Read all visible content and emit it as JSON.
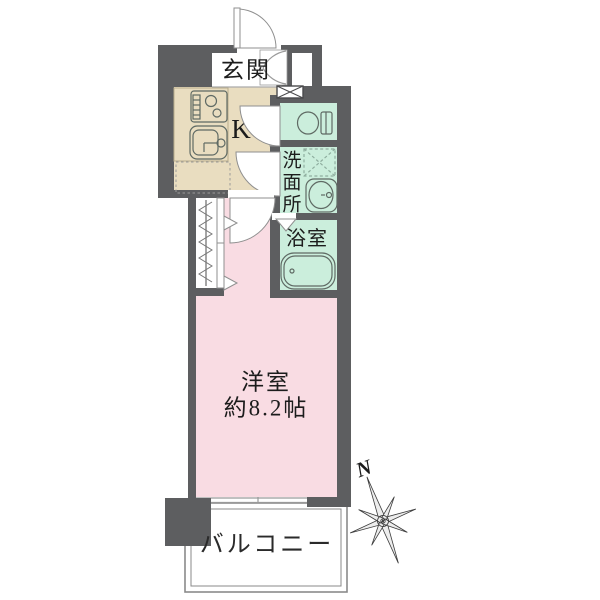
{
  "rooms": {
    "entrance": {
      "label": "玄関"
    },
    "kitchen": {
      "label": "K"
    },
    "washroom": {
      "label": "洗面所",
      "chars": [
        "洗",
        "面",
        "所"
      ]
    },
    "bathroom": {
      "label": "浴室"
    },
    "main_room": {
      "label": "洋室",
      "size": "約8.2帖"
    },
    "balcony": {
      "label": "バルコニー"
    }
  },
  "compass": {
    "north_label": "N"
  },
  "colors": {
    "wall": "#5d5e60",
    "kitchen_floor": "#e9ddc0",
    "wet_floor": "#cbeedc",
    "room_floor": "#f9dce3",
    "fixture_line": "#5f6a64",
    "text": "#1c1c1c"
  }
}
